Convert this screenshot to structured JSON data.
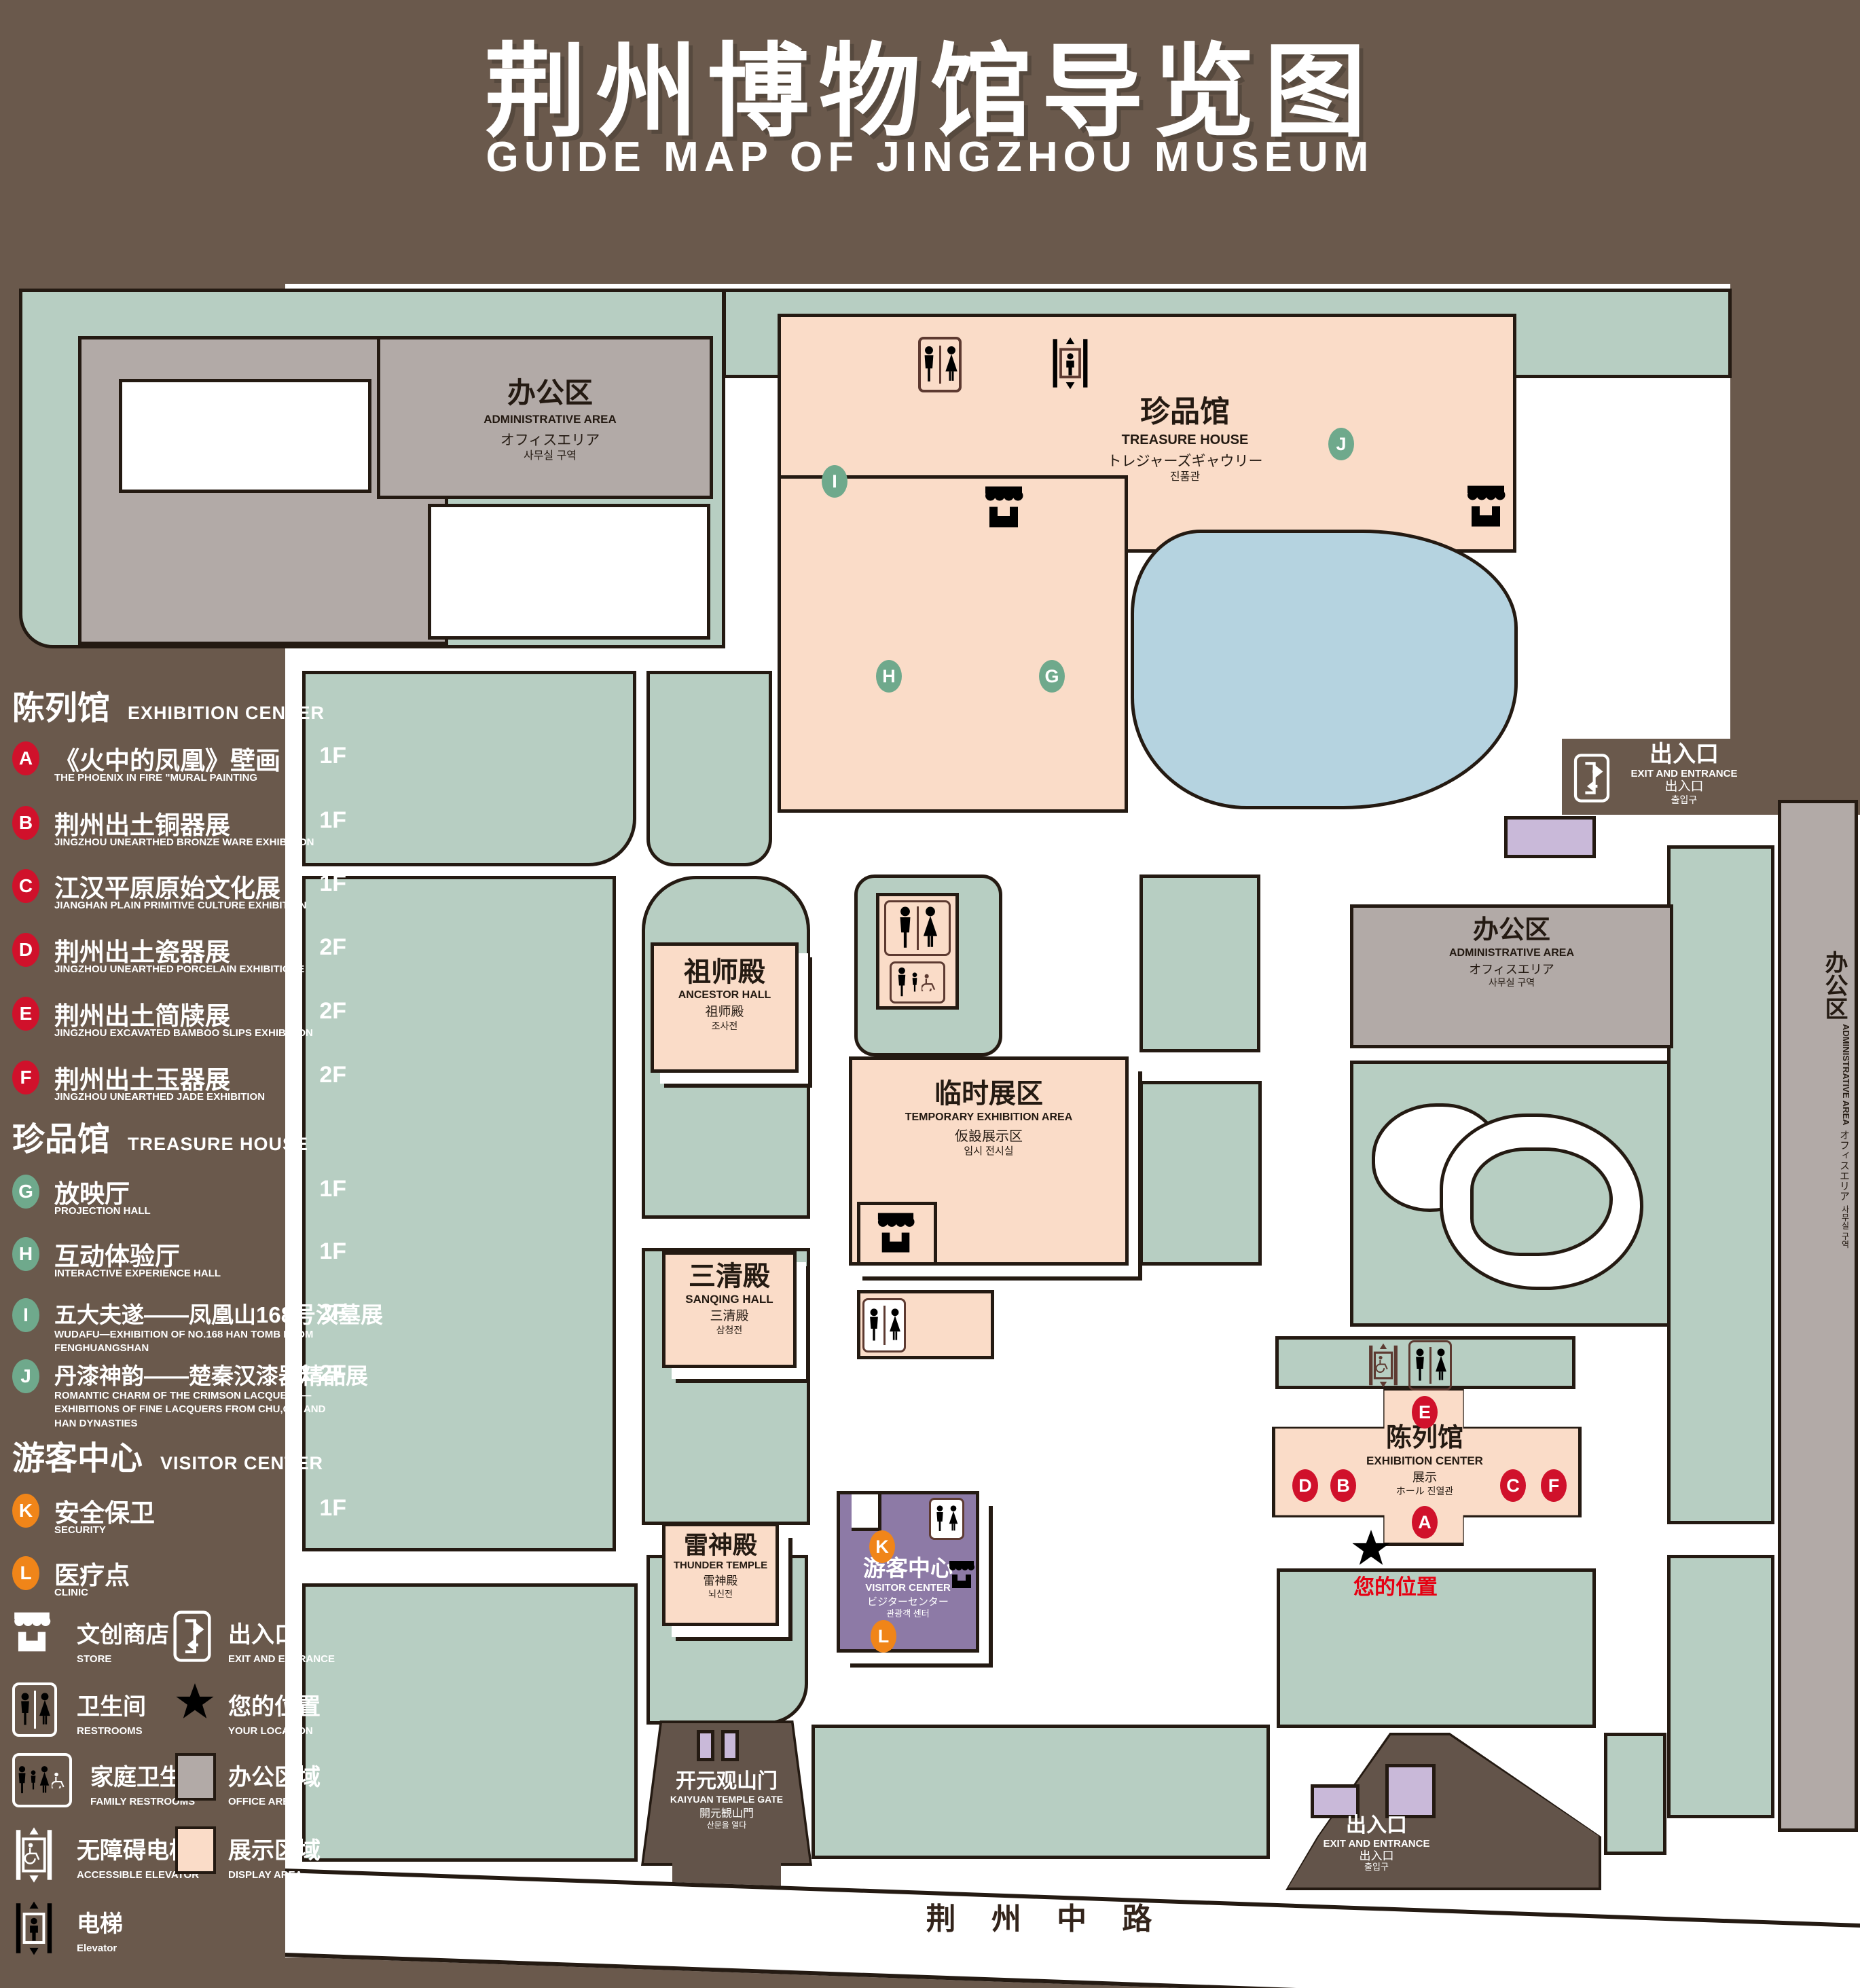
{
  "page": {
    "title_zh": "荆州博物馆导览图",
    "title_en": "GUIDE MAP OF JINGZHOU MUSEUM"
  },
  "colors": {
    "background": "#6a594c",
    "lawn": "#b7cec2",
    "display_area": "#fadcc8",
    "office_area": "#b2aaa7",
    "pond": "#b5d3e0",
    "visitor_center": "#8d7aa6",
    "gate_block": "#c9b9d9",
    "badge_red": "#d0112b",
    "badge_green": "#6fa98c",
    "badge_orange": "#f08519",
    "icon_brown": "#5d3a31",
    "star_red": "#e60012",
    "outline": "#241a12"
  },
  "legend": {
    "sections": [
      {
        "title_zh": "陈列馆",
        "title_en": "EXHIBITION CENTER",
        "items": [
          {
            "id": "A",
            "zh": "《火中的凤凰》壁画",
            "en": "THE PHOENIX IN FIRE \"MURAL PAINTING",
            "floor": "1F"
          },
          {
            "id": "B",
            "zh": "荆州出土铜器展",
            "en": "JINGZHOU UNEARTHED BRONZE WARE EXHIBITION",
            "floor": "1F"
          },
          {
            "id": "C",
            "zh": "江汉平原原始文化展",
            "en": "JIANGHAN PLAIN PRIMITIVE CULTURE EXHIBITION",
            "floor": "1F"
          },
          {
            "id": "D",
            "zh": "荆州出土瓷器展",
            "en": "JINGZHOU UNEARTHED PORCELAIN EXHIBITIONE",
            "floor": "2F"
          },
          {
            "id": "E",
            "zh": "荆州出土简牍展",
            "en": "JINGZHOU EXCAVATED BAMBOO SLIPS EXHIBITION",
            "floor": "2F"
          },
          {
            "id": "F",
            "zh": "荆州出土玉器展",
            "en": "JINGZHOU UNEARTHED JADE EXHIBITION",
            "floor": "2F"
          }
        ]
      },
      {
        "title_zh": "珍品馆",
        "title_en": "TREASURE HOUSE",
        "items": [
          {
            "id": "G",
            "zh": "放映厅",
            "en": "PROJECTION HALL",
            "floor": "1F"
          },
          {
            "id": "H",
            "zh": "互动体验厅",
            "en": "INTERACTIVE EXPERIENCE HALL",
            "floor": "1F"
          },
          {
            "id": "I",
            "zh": "五大夫遂——凤凰山168号汉墓展",
            "en": "WUDAFU—EXHIBITION OF NO.168 HAN TOMB FROM FENGHUANGSHAN",
            "floor": "2F"
          },
          {
            "id": "J",
            "zh": "丹漆神韵——楚秦汉漆器精品展",
            "en": "ROMANTIC CHARM OF THE CRIMSON LACQUERS—EXHIBITIONS OF FINE LACQUERS FROM CHU,QIN AND HAN DYNASTIES",
            "floor": "1-2F"
          }
        ]
      },
      {
        "title_zh": "游客中心",
        "title_en": "VISITOR CENTER",
        "items": [
          {
            "id": "K",
            "zh": "安全保卫",
            "en": "SECURITY",
            "floor": "1F"
          },
          {
            "id": "L",
            "zh": "医疗点",
            "en": "CLINIC",
            "floor": "1F"
          }
        ]
      }
    ],
    "symbols": {
      "store": {
        "zh": "文创商店",
        "en": "STORE"
      },
      "exit": {
        "zh": "出入口",
        "en": "EXIT AND ENTRANCE"
      },
      "restrooms": {
        "zh": "卫生间",
        "en": "RESTROOMS"
      },
      "location": {
        "zh": "您的位置",
        "en": "YOUR LOCATION"
      },
      "family": {
        "zh": "家庭卫生间",
        "en": "FAMILY RESTROOMS"
      },
      "office": {
        "zh": "办公区域",
        "en": "OFFICE AREA"
      },
      "accessible": {
        "zh": "无障碍电梯",
        "en": "ACCESSIBLE ELEVATOR"
      },
      "display": {
        "zh": "展示区域",
        "en": "DISPLAY AREA"
      },
      "elevator": {
        "zh": "电梯",
        "en": "Elevator"
      }
    }
  },
  "map": {
    "admin_nw": {
      "zh": "办公区",
      "en": "ADMINISTRATIVE AREA",
      "ja": "オフィスエリア",
      "ko": "사무실 구역"
    },
    "treasure": {
      "zh": "珍品馆",
      "en": "TREASURE HOUSE",
      "ja": "トレジャーズギャウリー",
      "ko": "진품관"
    },
    "ancestor": {
      "zh": "祖师殿",
      "en": "ANCESTOR HALL",
      "ja": "祖师殿",
      "ko": "조사전"
    },
    "temp": {
      "zh": "临时展区",
      "en": "TEMPORARY EXHIBITION AREA",
      "ja": "仮設展示区",
      "ko": "임시 전시실"
    },
    "admin_mid": {
      "zh": "办公区",
      "en": "ADMINISTRATIVE AREA",
      "ja": "オフィスエリア",
      "ko": "사무실 구역"
    },
    "admin_strip": {
      "zh": "办公区",
      "en": "ADMINISTRATIVE AREA",
      "ja": "オフィスエリア",
      "ko": "사무실 구역"
    },
    "sanqing": {
      "zh": "三清殿",
      "en": "SANQING HALL",
      "ja": "三清殿",
      "ko": "삼청전"
    },
    "thunder": {
      "zh": "雷神殿",
      "en": "THUNDER TEMPLE",
      "ja": "雷神殿",
      "ko": "뇌신전"
    },
    "exhibition": {
      "zh": "陈列馆",
      "en": "EXHIBITION CENTER",
      "ja": "展示",
      "ko": "ホール 진열관"
    },
    "visitor": {
      "zh": "游客中心",
      "en": "VISITOR CENTER",
      "ja": "ビジターセンター",
      "ko": "관광객 센터"
    },
    "gate": {
      "zh": "开元观山门",
      "en": "KAIYUAN TEMPLE GATE",
      "ja": "開元観山門",
      "ko": "산문을 열다"
    },
    "exit_ne": {
      "zh": "出入口",
      "en": "EXIT AND ENTRANCE",
      "ja": "出入口",
      "ko": "출입구"
    },
    "exit_se": {
      "zh": "出入口",
      "en": "EXIT AND ENTRANCE",
      "ja": "出入口",
      "ko": "출입구"
    },
    "your_location": "您的位置",
    "road": "荆 州 中 路",
    "badges": {
      "i": "I",
      "j": "J",
      "h": "H",
      "g": "G",
      "e": "E",
      "d": "D",
      "b": "B",
      "c": "C",
      "f": "F",
      "a": "A",
      "k": "K",
      "l": "L"
    }
  }
}
